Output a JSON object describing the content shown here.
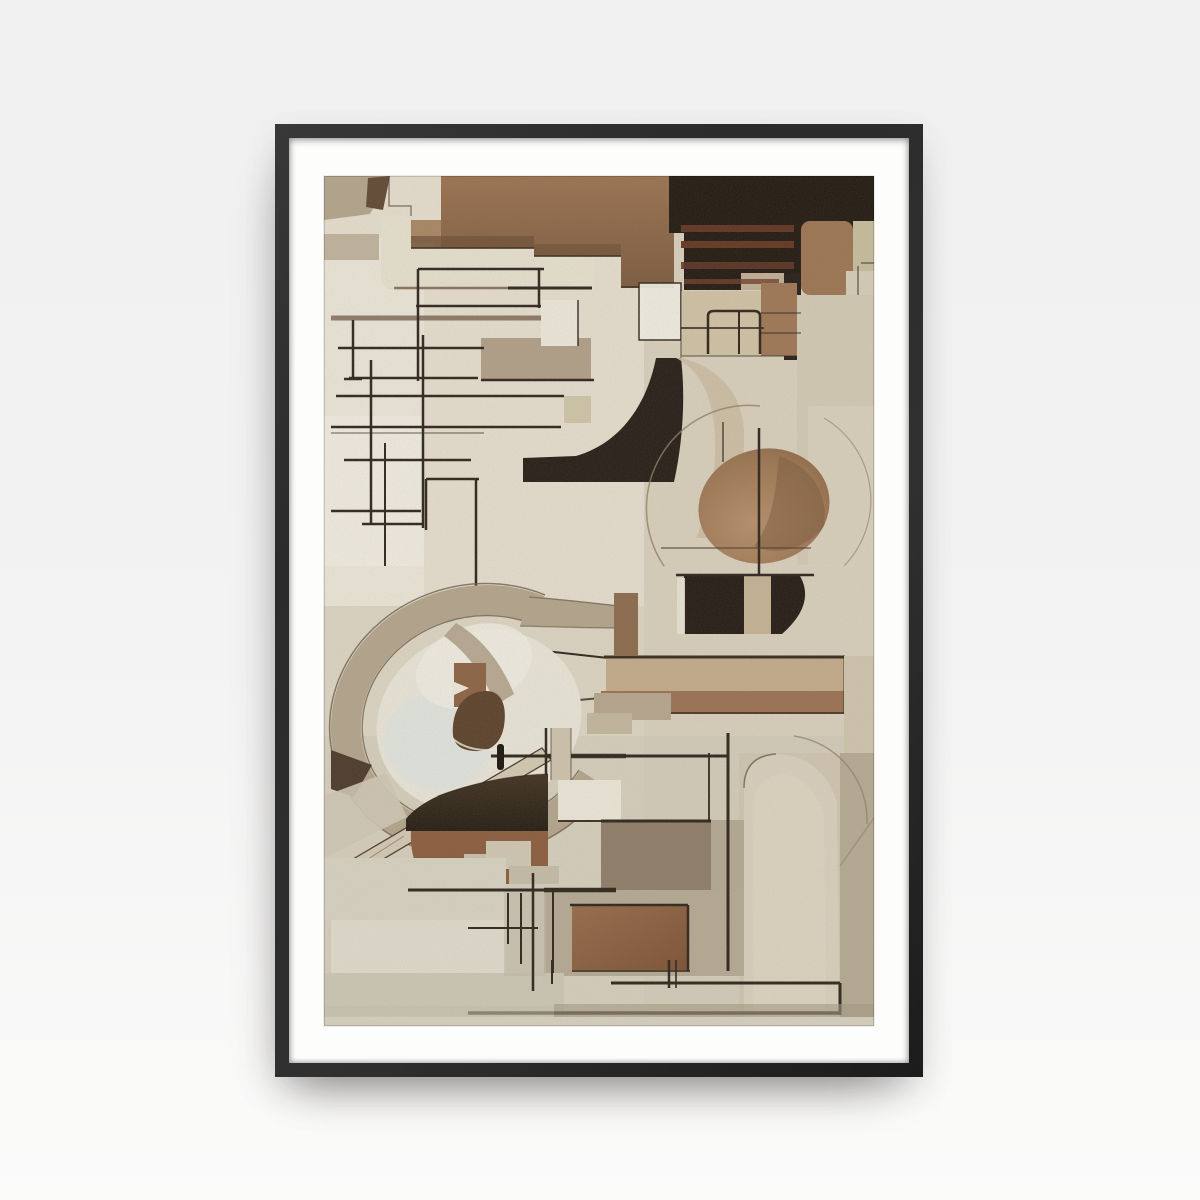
{
  "scene": {
    "description": "Product photograph of a vertical abstract-art poster in a thin black wooden frame with a wide white mat, hanging on a plain light wall",
    "artwork_style": "abstract geometric cubist composition; watercolor and charcoal textures; rectangles, arcs, an oval and thin scaffold lines",
    "orientation": "portrait",
    "visible_text": "",
    "frame": {
      "frame_color": "#2b2b2b",
      "mat_color": "#fdfdfc",
      "shadow": "soft drop shadow below and left of frame"
    },
    "palette": {
      "page_bg_top": "#f0f0f1",
      "page_bg_bottom": "#fbfbfa",
      "frame": "#2b2b2b",
      "mat": "#fdfdfc",
      "art_bg": "#dcd5c3",
      "cream_light": "#e9e4d5",
      "white_patch": "#f1eee3",
      "taupe": "#b2a48c",
      "taupe_dark": "#6b5b47",
      "tan_light": "#c2ab8a",
      "tan": "#a8835f",
      "brown": "#8a6245",
      "brown_deep": "#6b4c33",
      "umber": "#8d7d68",
      "rust": "#5e3323",
      "khaki": "#c6bd9d",
      "beige": "#cfc2a5",
      "dome": "#d8d0bd",
      "near_black": "#241c15",
      "line": "#2c231a",
      "blue_tint": "#dfe3e2"
    }
  }
}
